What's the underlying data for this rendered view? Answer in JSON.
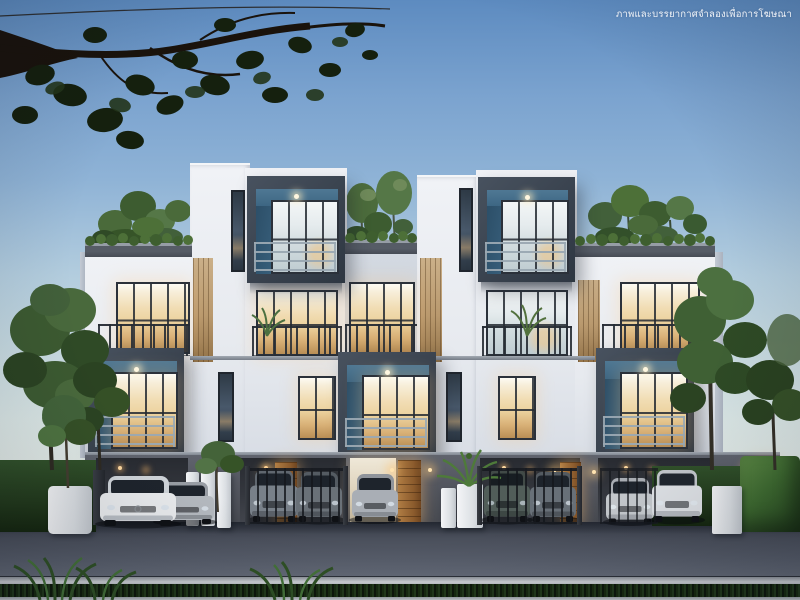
{
  "watermark": {
    "text": "ภาพและบรรยากาศจำลองเพื่อการโฆษณา",
    "color": "#ffffff"
  },
  "palette": {
    "skyTop": "#5d8bc0",
    "skyMid": "#8fb3d6",
    "skyLow": "#c6d9e0",
    "horizon": "#e4ebe7",
    "facade": "#e7eaef",
    "parapet": "#565c66",
    "boxFrame": "#39424e",
    "boxTeal": "#3d6683",
    "glassWarm": "#ecd29e",
    "frameDark": "#2b313a",
    "wood": "#b9996e",
    "doorWood": "#8a5a2c",
    "groundWall": "#45484f",
    "bayDark": "#34373e",
    "pillarWhite": "#dce0e4",
    "road": "#4a4f5b",
    "curb": "#cfd2d6",
    "grass": "#101b0c",
    "treeGreen": "#3f6034",
    "hedge": "#22391b",
    "hedgeLit": "#5d8a45",
    "carWhite": "#e9ebed",
    "carSilver": "#b4b9bf",
    "carGray": "#788089",
    "carDark": "#515d59"
  }
}
